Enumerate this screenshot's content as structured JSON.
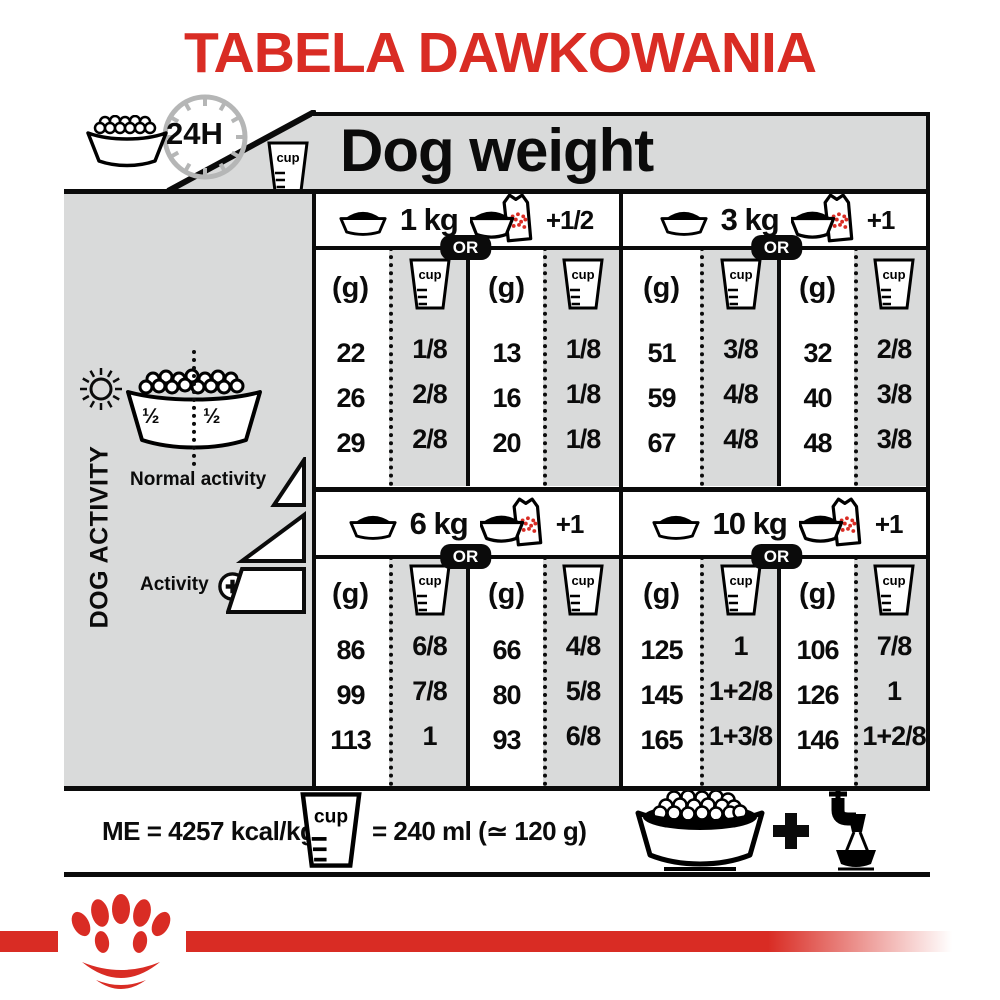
{
  "title": "TABELA DAWKOWANIA",
  "labels": {
    "cup": "cup"
  },
  "header": {
    "hours": "24H",
    "dog_weight": "Dog weight"
  },
  "sidebar": {
    "half_left": "½",
    "half_right": "½",
    "dog_activity": "DOG ACTIVITY",
    "normal_activity": "Normal activity",
    "activity": "Activity"
  },
  "table": {
    "or": "OR",
    "gram": "(g)",
    "quadrants": [
      {
        "weight": "1 kg",
        "extra": "+1/2",
        "dry_g": [
          "22",
          "26",
          "29"
        ],
        "dry_cup": [
          "1/8",
          "2/8",
          "2/8"
        ],
        "mix_g": [
          "13",
          "16",
          "20"
        ],
        "mix_cup": [
          "1/8",
          "1/8",
          "1/8"
        ]
      },
      {
        "weight": "3 kg",
        "extra": "+1",
        "dry_g": [
          "51",
          "59",
          "67"
        ],
        "dry_cup": [
          "3/8",
          "4/8",
          "4/8"
        ],
        "mix_g": [
          "32",
          "40",
          "48"
        ],
        "mix_cup": [
          "2/8",
          "3/8",
          "3/8"
        ]
      },
      {
        "weight": "6 kg",
        "extra": "+1",
        "dry_g": [
          "86",
          "99",
          "113"
        ],
        "dry_cup": [
          "6/8",
          "7/8",
          "1"
        ],
        "mix_g": [
          "66",
          "80",
          "93"
        ],
        "mix_cup": [
          "4/8",
          "5/8",
          "6/8"
        ]
      },
      {
        "weight": "10 kg",
        "extra": "+1",
        "dry_g": [
          "125",
          "145",
          "165"
        ],
        "dry_cup": [
          "1",
          "1+2/8",
          "1+3/8"
        ],
        "mix_g": [
          "106",
          "126",
          "146"
        ],
        "mix_cup": [
          "7/8",
          "1",
          "1+2/8"
        ]
      }
    ]
  },
  "footer": {
    "me": "ME = 4257 kcal/kg",
    "cup_equiv": "= 240 ml (≃ 120 g)",
    "plus": "+"
  },
  "colors": {
    "red": "#d92c24",
    "panel_gray": "#d9dada",
    "clock_gray": "#b5b6b6",
    "black": "#0b0b0b"
  }
}
